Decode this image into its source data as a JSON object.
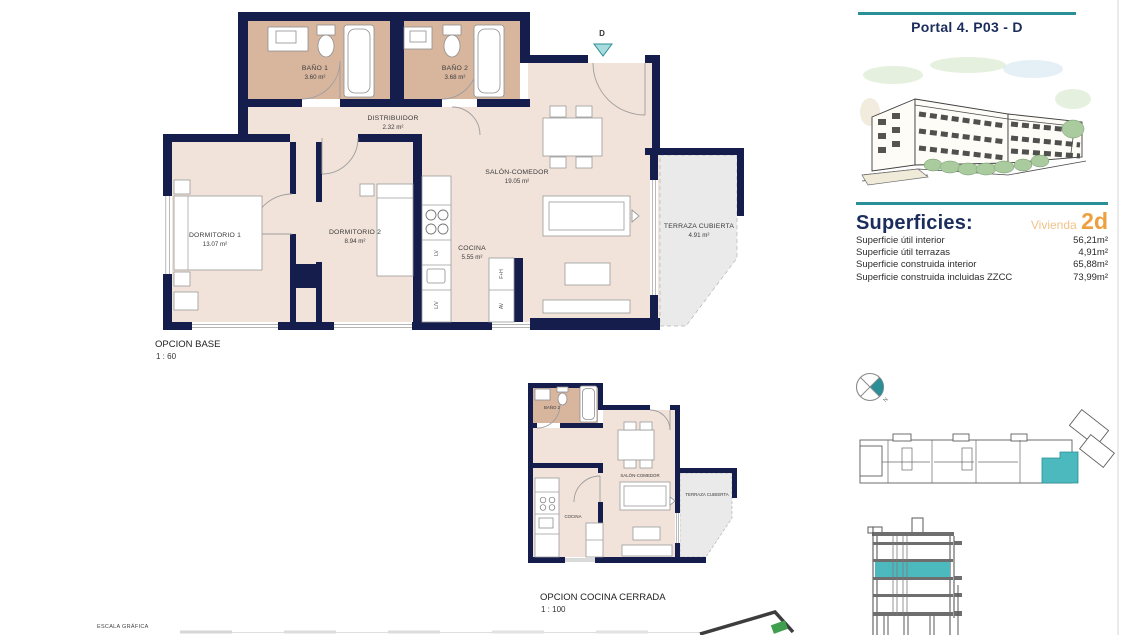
{
  "header": {
    "title": "Portal 4. P03 - D"
  },
  "surfaces": {
    "title": "Superficies:",
    "vivienda_label": "Vivienda",
    "vivienda_code": "2d",
    "rows": [
      {
        "label": "Superficie útil interior",
        "value": "56,21m²"
      },
      {
        "label": "Superficie útil terrazas",
        "value": "4,91m²"
      },
      {
        "label": "Superficie construida interior",
        "value": "65,88m²"
      },
      {
        "label": "Superficie construida incluidas ZZCC",
        "value": "73,99m²"
      }
    ]
  },
  "main_plan": {
    "caption": "OPCION BASE",
    "scale": "1 : 60",
    "entry_marker": "D",
    "rooms": {
      "dormitorio1": {
        "name": "DORMITORIO 1",
        "area": "13.07 m²"
      },
      "dormitorio2": {
        "name": "DORMITORIO 2",
        "area": "8.94 m²"
      },
      "bano1": {
        "name": "BAÑO 1",
        "area": "3.60 m²"
      },
      "bano2": {
        "name": "BAÑO 2",
        "area": "3.68 m²"
      },
      "distribuidor": {
        "name": "DISTRIBUIDOR",
        "area": "2.32 m²"
      },
      "salon": {
        "name": "SALÓN-COMEDOR",
        "area": "19.05 m²"
      },
      "cocina": {
        "name": "COCINA",
        "area": "5.55 m²"
      },
      "terraza": {
        "name": "TERRAZA CUBIERTA",
        "area": "4.91 m²"
      }
    },
    "appliances": {
      "lv": "LV",
      "lvd": "L/V",
      "fh": "F+H",
      "av": "AV"
    }
  },
  "secondary_plan": {
    "caption": "OPCION COCINA CERRADA",
    "scale": "1 : 100",
    "rooms": {
      "bano2": "BAÑO 2",
      "salon": "SALÓN-COMEDOR",
      "cocina": "COCINA",
      "terraza": "TERRAZA CUBIERTA"
    }
  },
  "compass": {
    "north_label": "N"
  },
  "footer": {
    "escala_label": "ESCALA GRÁFICA"
  },
  "colors": {
    "accent_teal": "#2a8f96",
    "highlight_teal": "#4bb9be",
    "wall_navy": "#141d4c",
    "floor_beige": "#f2e3da",
    "bath_tan": "#d8b69e",
    "terrace_gray": "#eaeaea",
    "orange": "#ee9f3e",
    "orange_light": "#f1c289",
    "navy_text": "#1b2d5c",
    "logo_green": "#3f9f4e"
  }
}
